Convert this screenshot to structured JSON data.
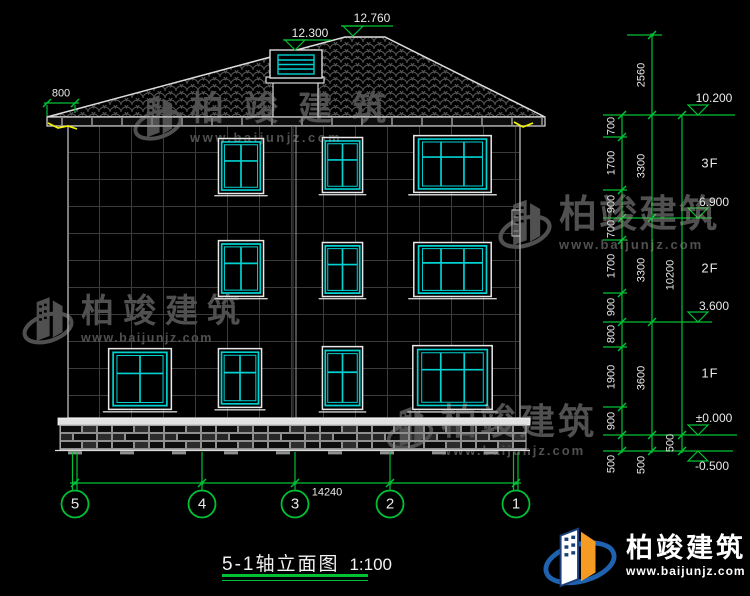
{
  "title": {
    "text": "5-1轴立面图",
    "scale": "1:100"
  },
  "top_dims": {
    "chimney_level": "12.300",
    "ridge_level": "12.760",
    "eave_overhang": "800"
  },
  "bottom_dims": {
    "total_width": "14240"
  },
  "right_dims": {
    "inner": [
      "700",
      "1700",
      "900",
      "700",
      "1700",
      "900",
      "800",
      "1900",
      "900",
      "500"
    ],
    "middle": [
      "2560",
      "3300",
      "3300",
      "3600",
      "500"
    ],
    "outer": [
      "10200",
      "500"
    ]
  },
  "levels": [
    "10.200",
    "6.900",
    "3.600",
    "±0.000",
    "-0.500"
  ],
  "floors": [
    "3F",
    "2F",
    "1F"
  ],
  "axes": [
    "5",
    "4",
    "3",
    "2",
    "1"
  ],
  "watermark": {
    "brand": "柏竣建筑",
    "url": "www.baijunjz.com"
  },
  "logo": {
    "brand": "柏竣建筑",
    "url": "www.baijunjz.com"
  },
  "colors": {
    "background": "#000000",
    "dim_green": "#00c135",
    "window_cyan": "#00d2d2",
    "line_white": "#e8e8e8",
    "watermark_gray": "#505050",
    "logo_blue": "#1e62b0",
    "logo_orange": "#f59a23",
    "gutter_yellow": "#f5f500"
  }
}
